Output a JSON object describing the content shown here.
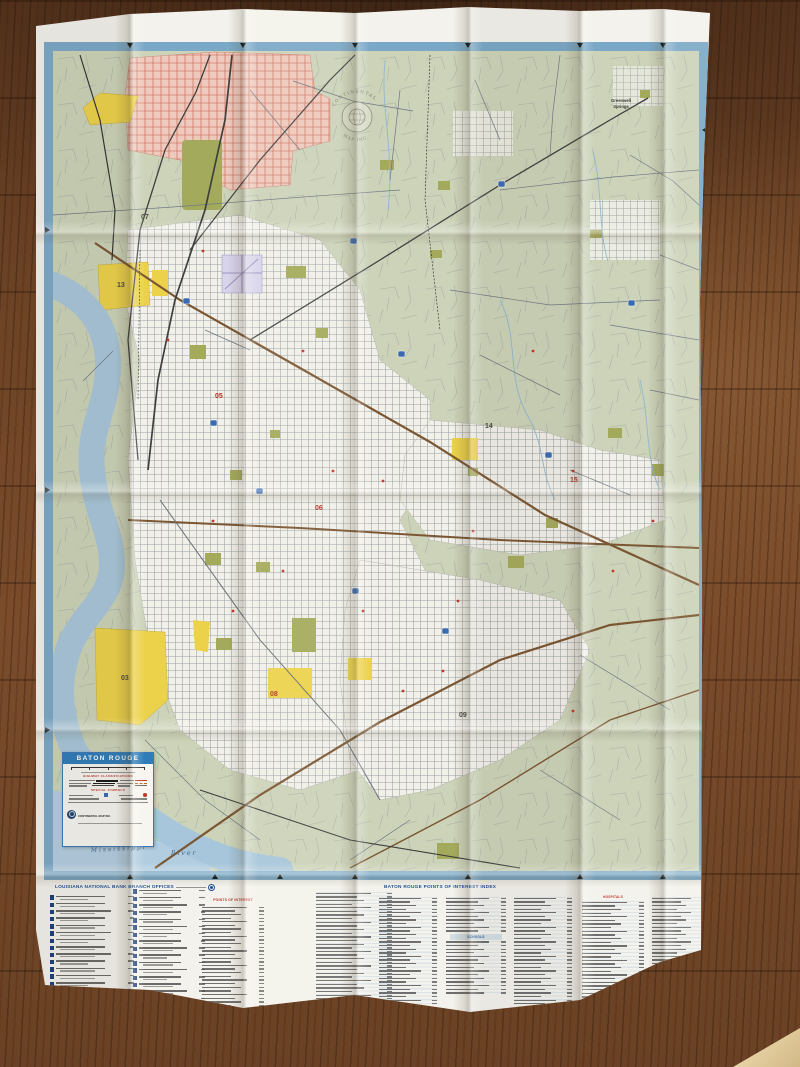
{
  "map_sheet": {
    "title_box": {
      "title": "BATON ROUGE",
      "highway_heading": "HIGHWAY CLASSIFICATIONS",
      "symbols_heading": "SPECIAL SYMBOLS",
      "publisher": "CONTINENTAL MAP INC."
    },
    "logo": {
      "line1": "CONTINENTAL",
      "line2": "MAP INC."
    },
    "place_labels": {
      "greenwell_springs_1": "Greenwell",
      "greenwell_springs_2": "Springs",
      "mississippi": "Mississippi",
      "river": "River"
    },
    "district_numbers": {
      "d03": "03",
      "d05": "05",
      "d06": "06",
      "d07": "07",
      "d08": "08",
      "d09": "09",
      "d13": "13",
      "d14": "14",
      "d15": "15"
    }
  },
  "index_panel": {
    "bank_header": "LOUISIANA NATIONAL BANK BRANCH OFFICES",
    "poi_header": "POINTS OF INTEREST",
    "main_header": "BATON ROUGE POINTS OF INTEREST INDEX",
    "hospitals_header": "HOSPITALS",
    "schools_header": "SCHOOLS"
  },
  "colors": {
    "frame_blue": "#7aa8c7",
    "banner_blue": "#2e7cb8",
    "heading_red": "#c0392e",
    "index_blue": "#1d4f96",
    "map_green": "#ccd3b9",
    "urban_pink": "#eec9bd",
    "industrial_yellow": "#ecd24a",
    "water_blue": "#a7c6db",
    "park_olive": "#a4aa5c",
    "wood_brown": "#6f4526"
  }
}
